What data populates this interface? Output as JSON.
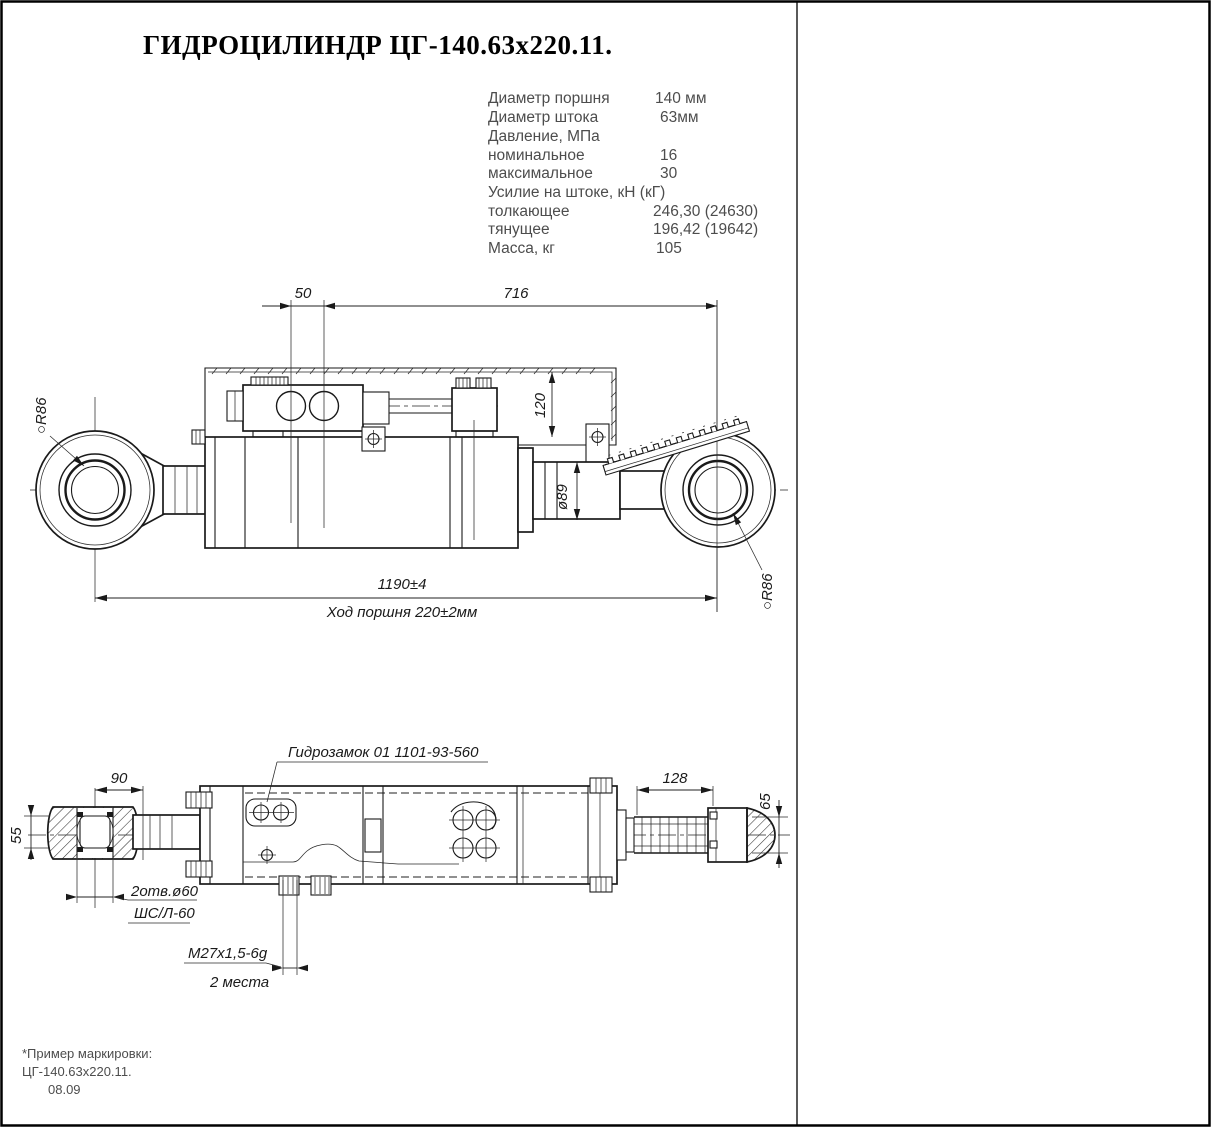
{
  "title": "ГИДРОЦИЛИНДР ЦГ-140.63х220.11.",
  "specs": {
    "rows": [
      {
        "label": "Диаметр поршня",
        "value": "140 мм"
      },
      {
        "label": "Диаметр штока",
        "value": "63мм"
      },
      {
        "label": "Давление, МПа",
        "value": ""
      },
      {
        "label": "номинальное",
        "value": "16"
      },
      {
        "label": "максимальное",
        "value": "30"
      },
      {
        "label": "Усилие на штоке, кН (кГ)",
        "value": ""
      },
      {
        "label": "толкающее",
        "value": "246,30 (24630)"
      },
      {
        "label": "тянущее",
        "value": "196,42 (19642)"
      },
      {
        "label": "Масса, кг",
        "value": "105"
      }
    ]
  },
  "top_view": {
    "dim_50": "50",
    "dim_716": "716",
    "dim_120": "120",
    "dim_d89": "ø89",
    "dim_length": "1190±4",
    "dim_stroke": "Ход поршня 220±2мм",
    "r86_left": "○R86",
    "r86_right": "○R86"
  },
  "plan_view": {
    "hydrolock_label": "Гидрозамок 01 1101-93-560",
    "dim_90": "90",
    "dim_55": "55",
    "dim_128": "128",
    "dim_65": "65",
    "holes_label": "2отв.ø60",
    "bearing_label": "ШС/Л-60",
    "thread_label": "М27х1,5-6g",
    "places_label": "2 места"
  },
  "note": {
    "line1": "*Пример маркировки:",
    "line2": "ЦГ-140.63х220.11.",
    "line3": "08.09"
  }
}
